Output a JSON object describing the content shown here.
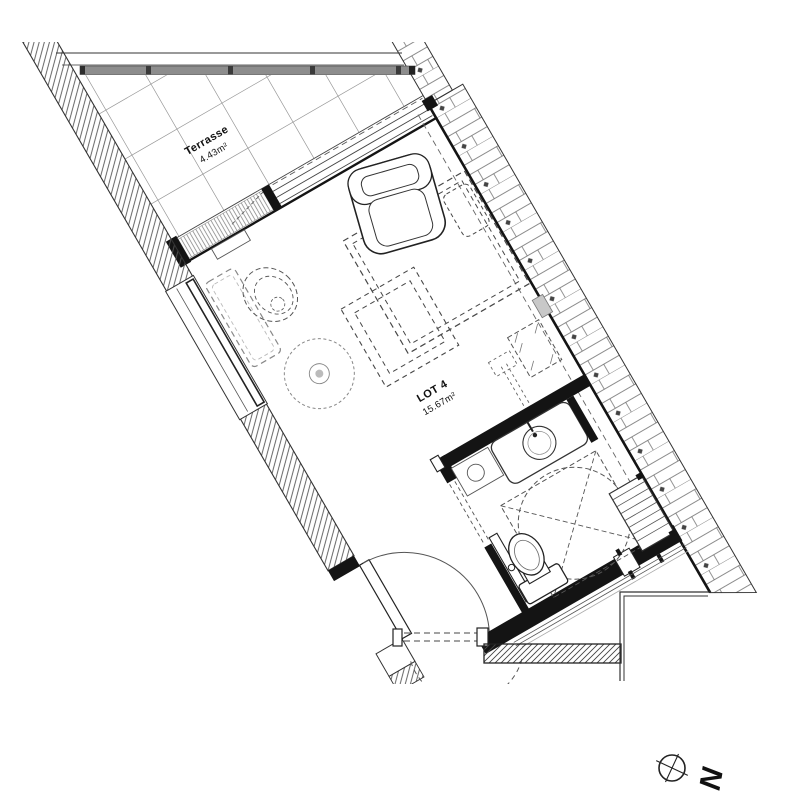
{
  "plan": {
    "rooms": [
      {
        "name": "Terrasse",
        "area": "4.43m²"
      },
      {
        "name": "LOT 4",
        "area": "15.67m²"
      }
    ],
    "compass": {
      "label": "N",
      "icon": "compass-crosshair-icon"
    },
    "colors": {
      "background": "#ffffff",
      "line": "#222222",
      "poche": "#141414",
      "railing_band": "#8d8d8d",
      "hatch": "#555555",
      "furniture_dash": "#474747",
      "light_gray": "#c8c8c8"
    }
  }
}
